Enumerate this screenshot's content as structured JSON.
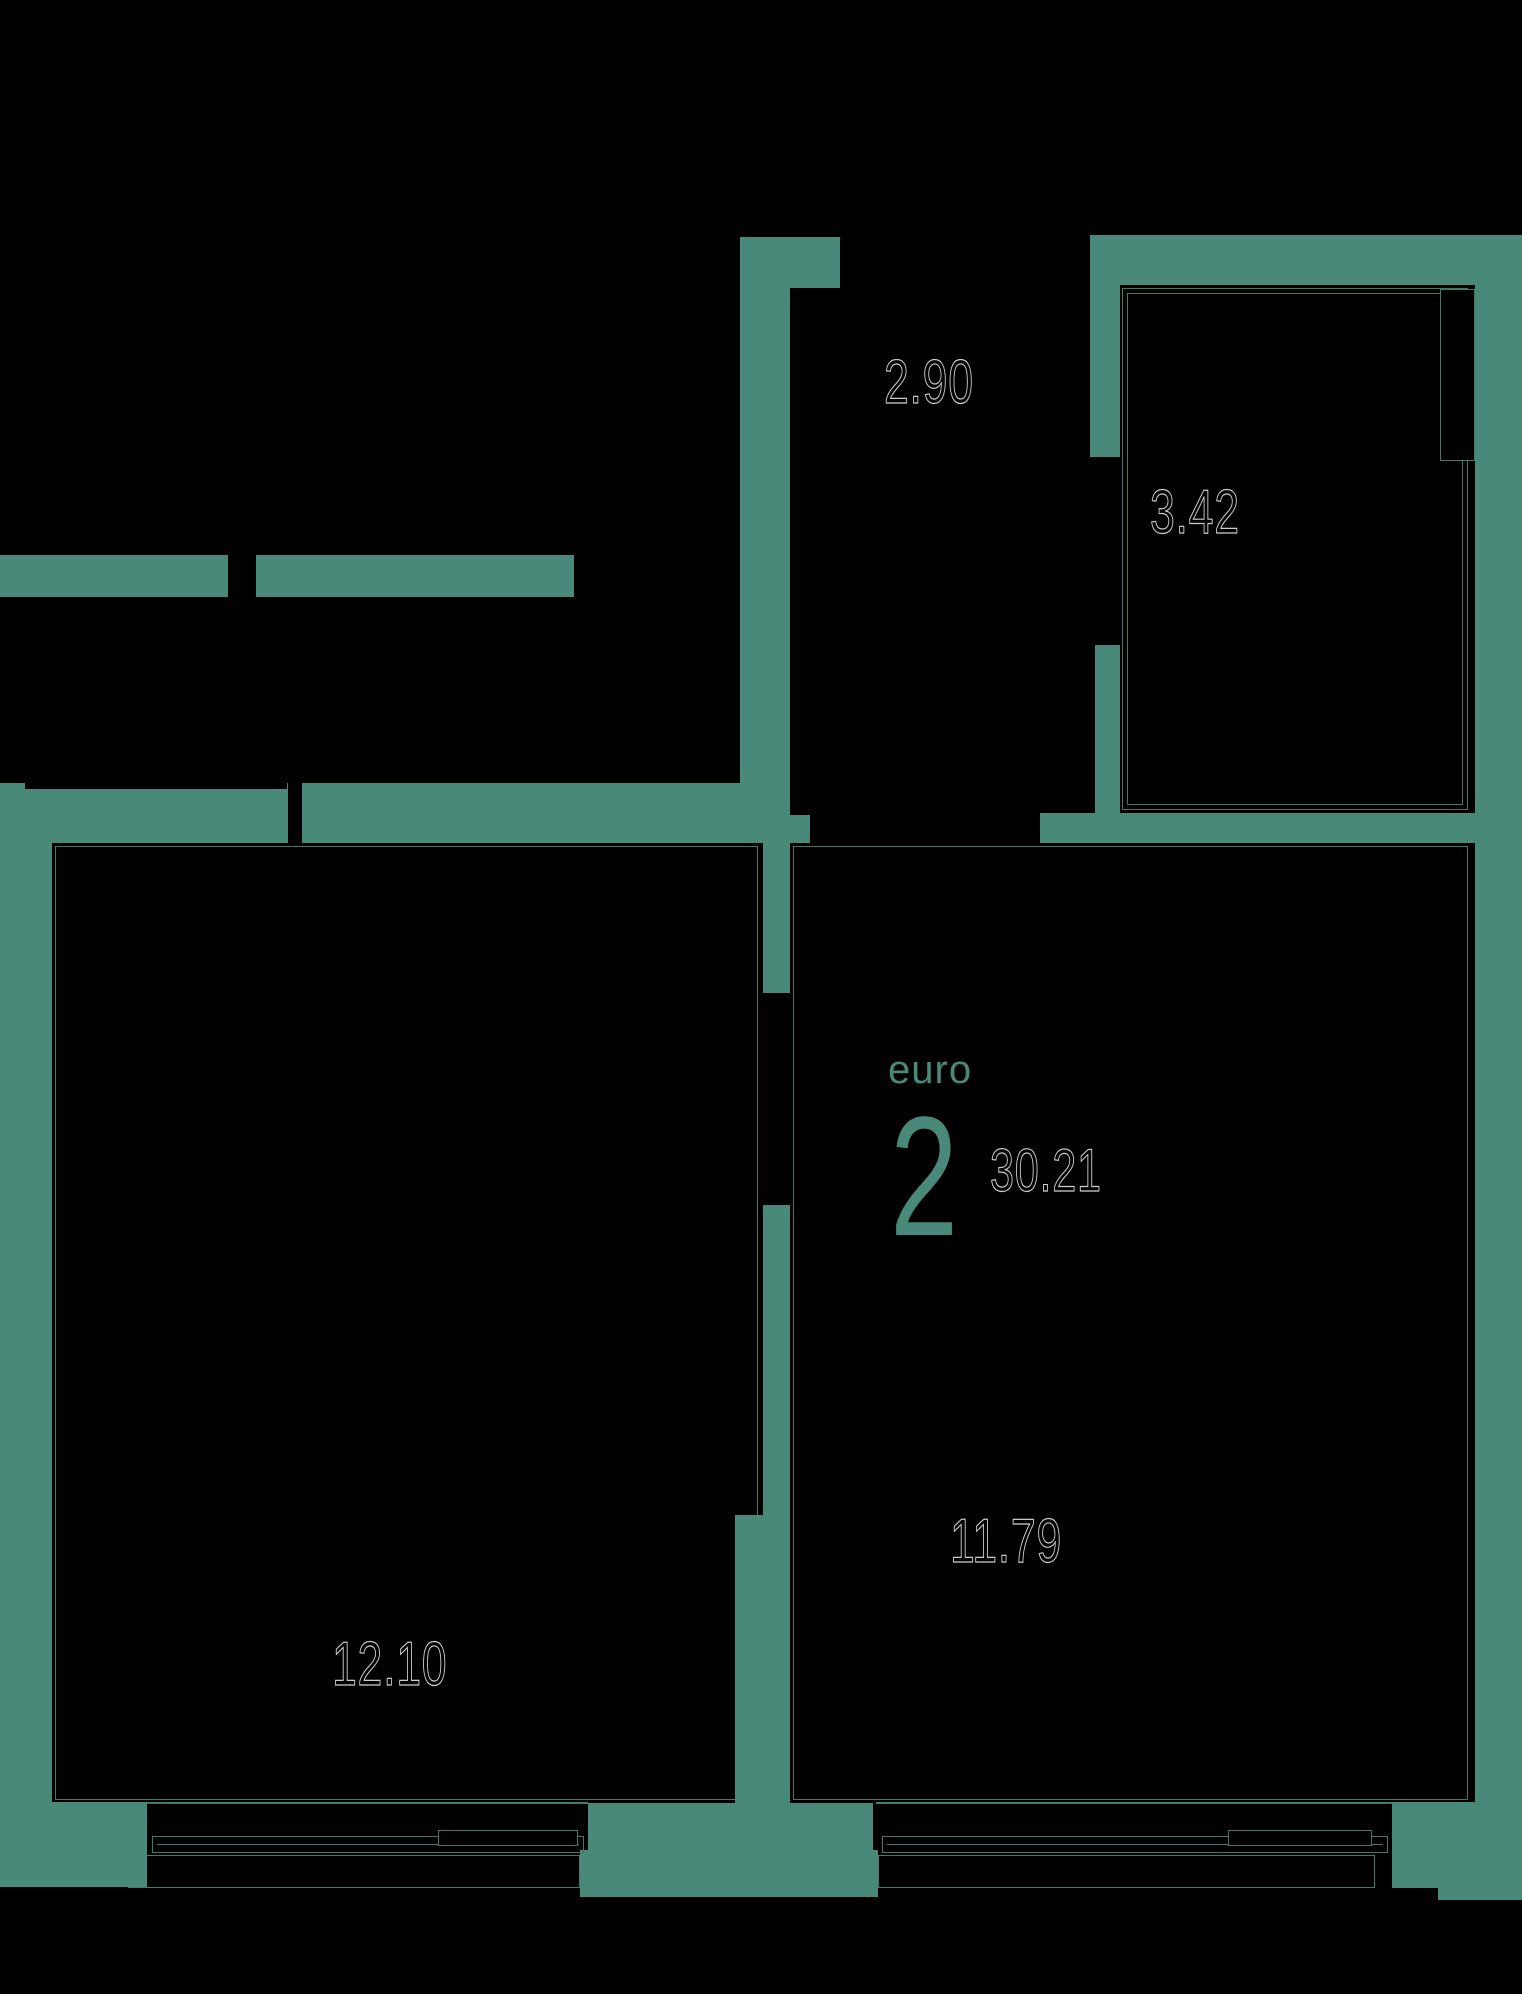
{
  "floor_plan": {
    "unit_type_label": "euro",
    "unit_rooms_count": "2",
    "unit_total_area": "30.21",
    "areas": {
      "top_center": "2.90",
      "top_right": "3.42",
      "bottom_right": "11.79",
      "bottom_left": "12.10"
    },
    "colors": {
      "wall": "#48897a",
      "thin_line": "#3f7a6b",
      "background": "#000000",
      "label_outline": "#c8cdc9"
    }
  }
}
